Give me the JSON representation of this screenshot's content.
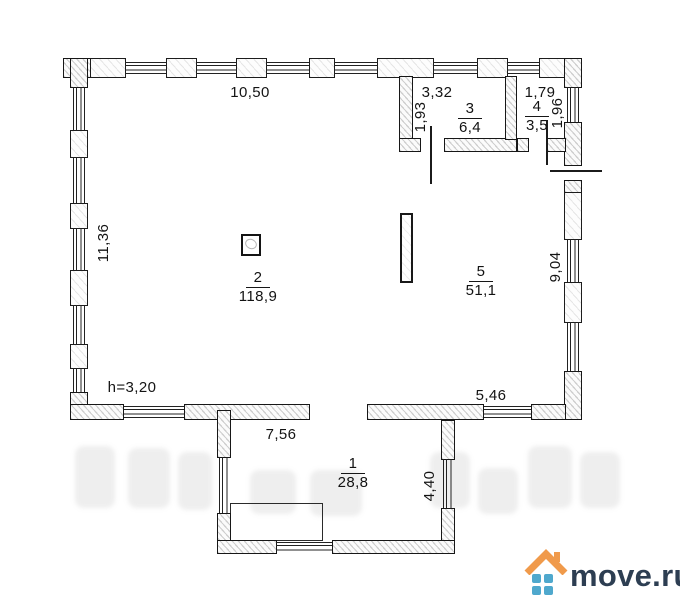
{
  "rooms": {
    "r1": {
      "number": "1",
      "area": "28,8"
    },
    "r2": {
      "number": "2",
      "area": "118,9"
    },
    "r3": {
      "number": "3",
      "area": "6,4"
    },
    "r4": {
      "number": "4",
      "area": "3,5"
    },
    "r5": {
      "number": "5",
      "area": "51,1"
    }
  },
  "dims": {
    "top": "10,50",
    "left": "11,36",
    "right": "9,04",
    "r3_top": "3,32",
    "r3_left": "1,93",
    "r4_top": "1,79",
    "r4_right": "1,96",
    "ceiling": "h=3,20",
    "bottom_left": "7,56",
    "bottom_right": "5,46",
    "ext_right": "4,40"
  },
  "logo": {
    "text": "move.ru"
  }
}
